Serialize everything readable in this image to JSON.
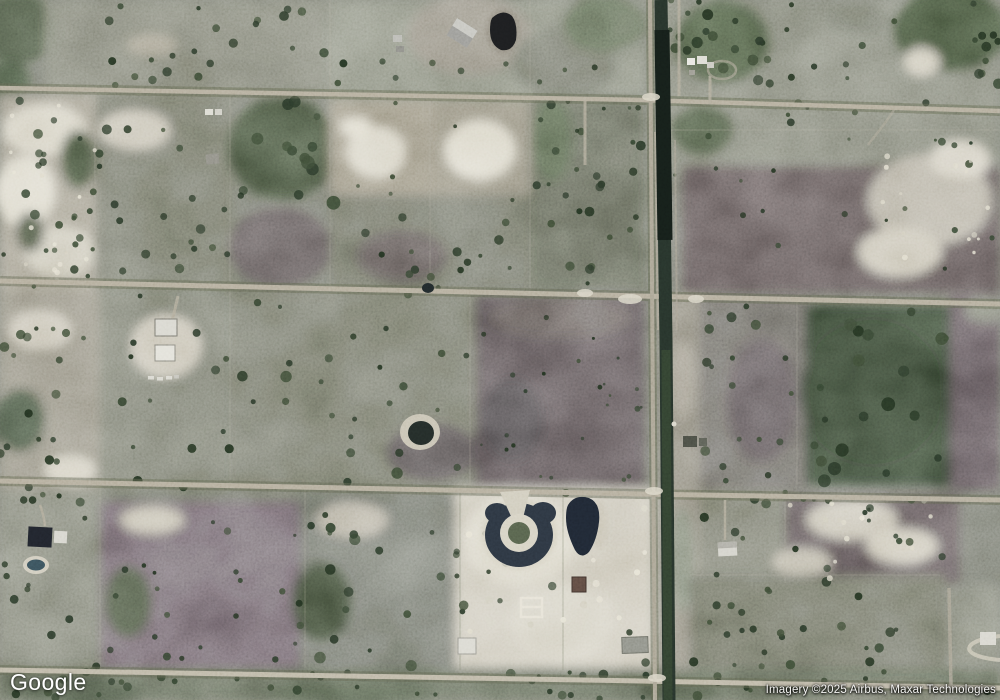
{
  "branding": {
    "logo_text": "Google"
  },
  "attribution": {
    "text": "Imagery ©2025 Airbus, Maxar Technologies"
  },
  "palette": {
    "terrain_base": "#73766a",
    "road_surface": "#b3ac9b",
    "road_verge": "#5f644f",
    "canal_water": "#1c2620",
    "pond_water": "#1f2733",
    "sand": "#cdc8b9",
    "forest": "#32402e",
    "scrub_purple": "#6a5e66",
    "overlay_text": "#ffffff"
  }
}
